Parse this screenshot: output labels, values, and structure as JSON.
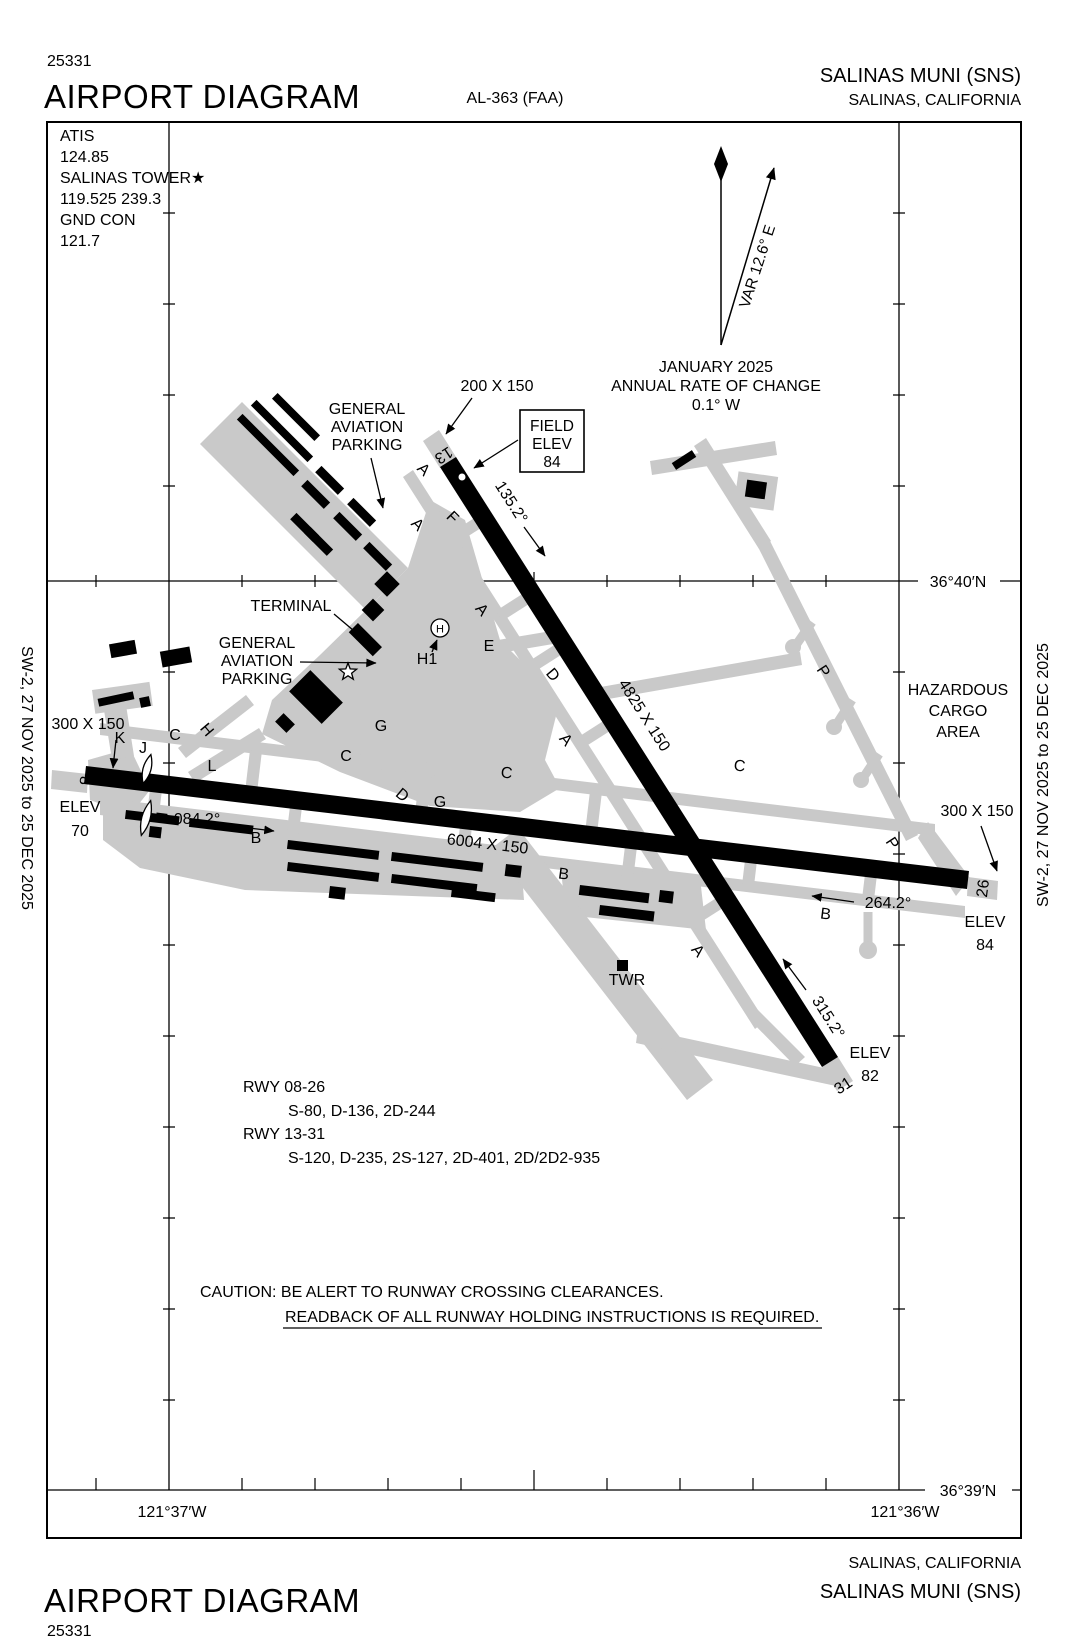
{
  "header": {
    "chart_number": "25331",
    "title": "AIRPORT DIAGRAM",
    "procedure": "AL-363 (FAA)",
    "airport": "SALINAS MUNI (SNS)",
    "city": "SALINAS, CALIFORNIA"
  },
  "footer": {
    "title": "AIRPORT DIAGRAM",
    "chart_number": "25331",
    "airport": "SALINAS MUNI (SNS)",
    "city": "SALINAS, CALIFORNIA"
  },
  "margin": {
    "left": "SW-2,  27 NOV 2025  to  25 DEC 2025",
    "right": "SW-2,  27 NOV 2025  to  25 DEC 2025"
  },
  "comms": [
    "ATIS",
    "124.85",
    "SALINAS TOWER★",
    "119.525  239.3",
    "GND CON",
    "121.7"
  ],
  "compass": {
    "variation": "VAR 12.6° E",
    "lines": [
      "JANUARY 2025",
      "ANNUAL RATE OF CHANGE",
      "0.1° W"
    ]
  },
  "field_elev": [
    "FIELD",
    "ELEV",
    "84"
  ],
  "graticule": {
    "lat40": "36°40′N",
    "lat39": "36°39′N",
    "lon37": "121°37′W",
    "lon36": "121°36′W"
  },
  "runway_13_31": {
    "num13": "13",
    "num31": "31",
    "hdg13": "135.2°",
    "hdg31": "315.2°",
    "size": "4825 X 150",
    "stub": "200 X 150",
    "elev31": [
      "ELEV",
      "82"
    ]
  },
  "runway_08_26": {
    "num8": "8",
    "num26": "26",
    "hdg08": "084.2°",
    "hdg26": "264.2°",
    "size": "6004 X 150",
    "stub_west": "300 X 150",
    "stub_east": "300 X 150",
    "elev8": [
      "ELEV",
      "70"
    ],
    "elev26": [
      "ELEV",
      "84"
    ]
  },
  "labels": {
    "terminal": "TERMINAL",
    "ga_north": [
      "GENERAL",
      "AVIATION",
      "PARKING"
    ],
    "ga_south": [
      "GENERAL",
      "AVIATION",
      "PARKING"
    ],
    "hazardous": [
      "HAZARDOUS",
      "CARGO",
      "AREA"
    ],
    "twr": "TWR",
    "h1": "H1",
    "helipad": "H"
  },
  "runway_data": {
    "rwy1_label": "RWY 08-26",
    "rwy1_codes": "S-80, D-136, 2D-244",
    "rwy2_label": "RWY 13-31",
    "rwy2_codes": "S-120, D-235, 2S-127, 2D-401, 2D/2D2-935"
  },
  "caution": {
    "line1": "CAUTION: BE ALERT TO RUNWAY CROSSING CLEARANCES.",
    "line2": "READBACK OF ALL RUNWAY HOLDING INSTRUCTIONS IS REQUIRED."
  },
  "taxiways": [
    "A",
    "A",
    "F",
    "A",
    "E",
    "D",
    "A",
    "C",
    "C",
    "C",
    "C",
    "G",
    "D",
    "G",
    "H",
    "K",
    "J",
    "L",
    "N",
    "B",
    "B",
    "B",
    "A",
    "P",
    "P"
  ],
  "colors": {
    "pavement": "#c9c9c9",
    "ink": "#000000"
  }
}
